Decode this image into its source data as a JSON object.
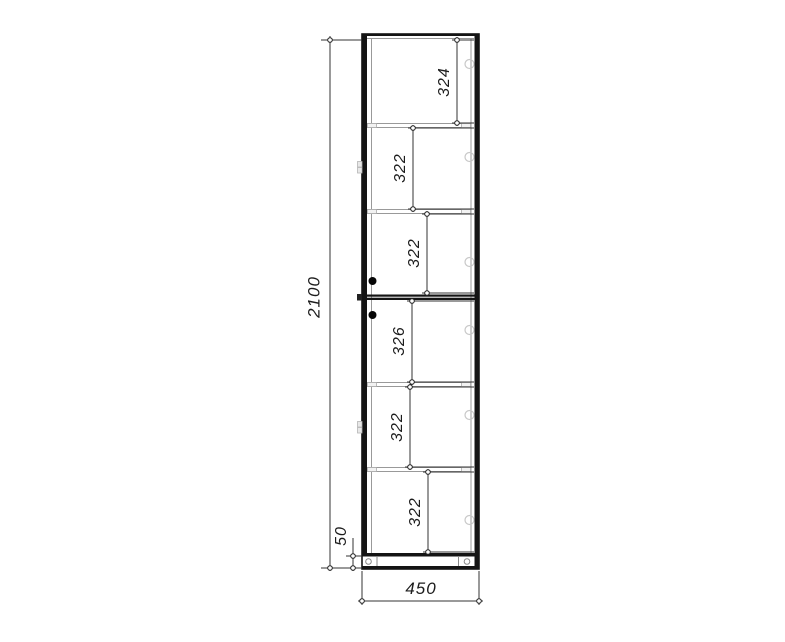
{
  "drawing": {
    "dimensions": {
      "overall_height": "2100",
      "overall_width": "450",
      "base_height": "50",
      "compartments": [
        "324",
        "322",
        "322",
        "326",
        "322",
        "322"
      ]
    },
    "colors": {
      "outline": "#141414",
      "thin_line": "#999999",
      "dimension_line": "#333333",
      "fitting_circle": "#c8c8c8",
      "handle": "#050505",
      "background": "#ffffff"
    }
  }
}
